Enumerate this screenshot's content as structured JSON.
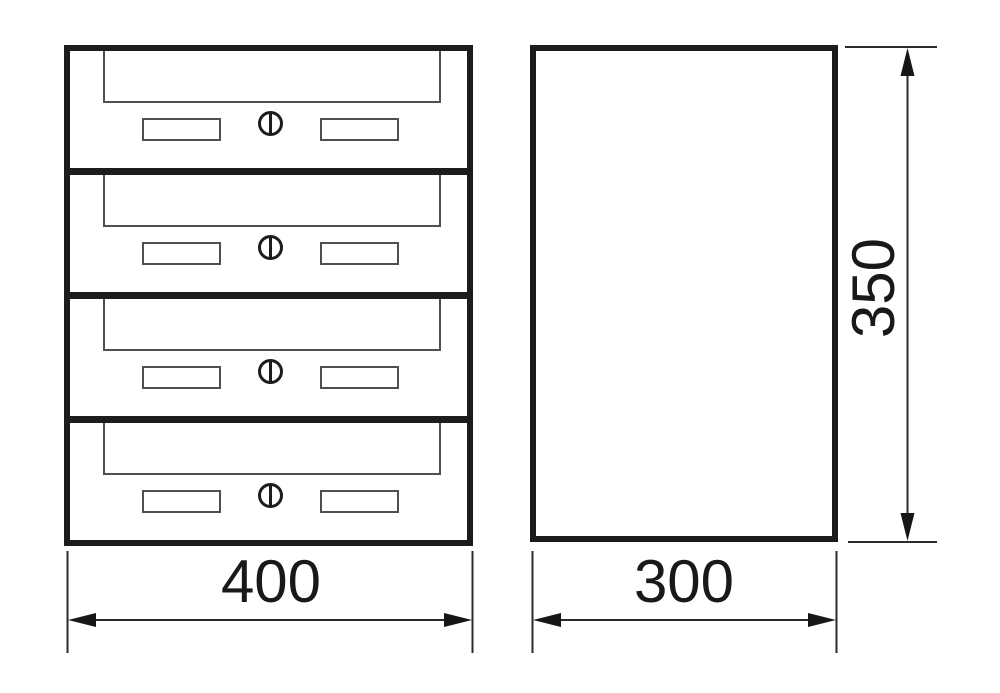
{
  "drawing": {
    "type": "technical-drawing",
    "subject": "four-unit stacked mailbox, front and side orthographic views",
    "front_view": {
      "name": "front-view",
      "unit_count": 4,
      "unit_features": [
        "mail-flap",
        "name-plate-left",
        "cam-lock",
        "name-plate-right"
      ]
    },
    "side_view": {
      "name": "side-view"
    },
    "dimensions": {
      "front_width": {
        "label": "400"
      },
      "side_width": {
        "label": "300"
      },
      "side_height": {
        "label": "350"
      }
    },
    "colors": {
      "outline_thick": "#1c1c1e",
      "outline_thin": "#4e4e55",
      "dimension_line": "#2b2b2e",
      "text": "#19191b",
      "background": "#ffffff"
    }
  }
}
